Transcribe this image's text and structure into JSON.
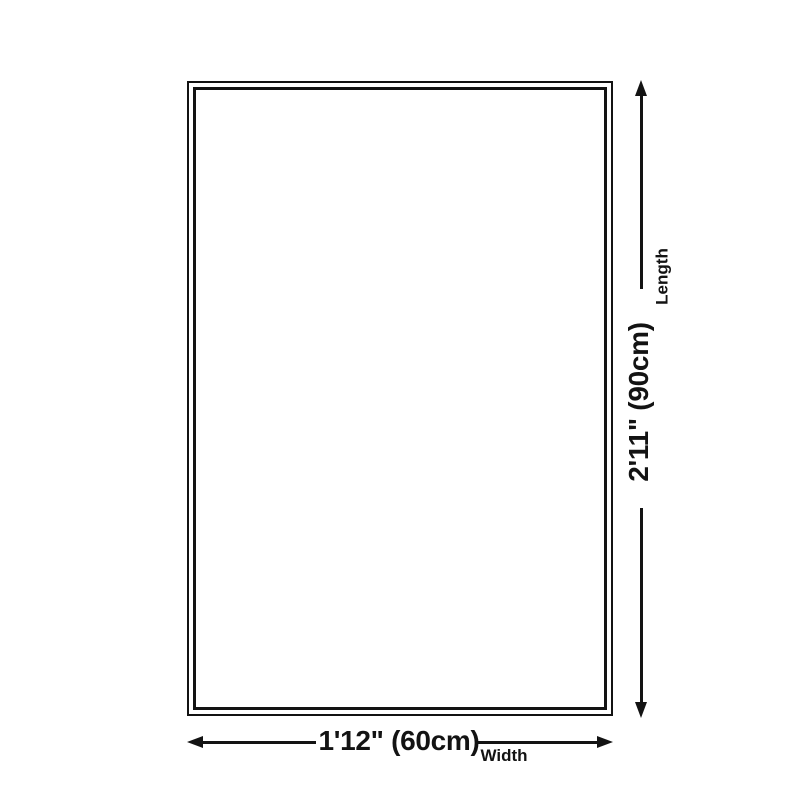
{
  "page": {
    "background_color": "#ffffff",
    "ink_color": "#131313",
    "kind": "product-dimension-diagram"
  },
  "diagram": {
    "rug": {
      "name": "rug-outline",
      "border_style": "double"
    },
    "length": {
      "value": "2'11\" (90cm)",
      "label": "Length"
    },
    "width": {
      "value": "1'12\" (60cm)",
      "label": "Width"
    }
  }
}
